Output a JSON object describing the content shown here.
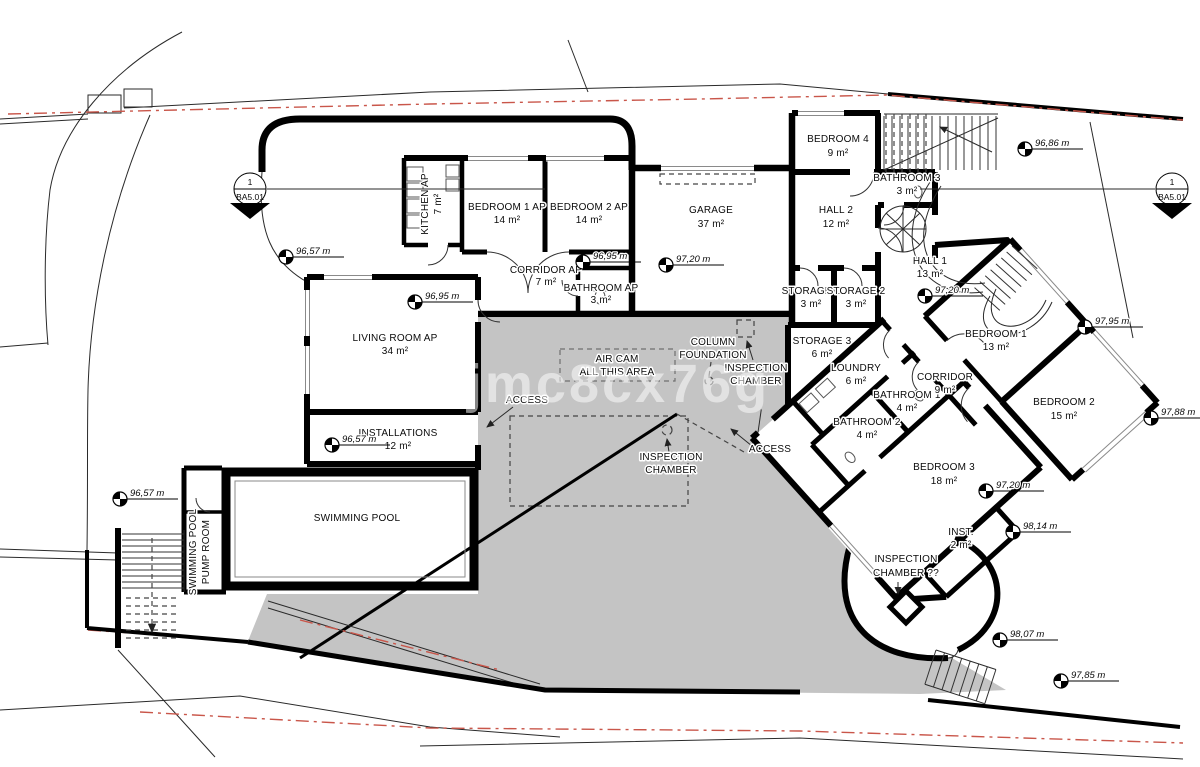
{
  "watermark": "kjmc8cx76g",
  "section_marker": {
    "number": "1",
    "sheet": "BA5.01"
  },
  "rooms": [
    {
      "name": "KITCHEN AP",
      "area": "7 m²"
    },
    {
      "name": "BEDROOM 1 AP",
      "area": "14 m²"
    },
    {
      "name": "BEDROOM 2 AP",
      "area": "14 m²"
    },
    {
      "name": "GARAGE",
      "area": "37 m²"
    },
    {
      "name": "BEDROOM 4",
      "area": "9 m²"
    },
    {
      "name": "BATHROOM 3",
      "area": "3 m²"
    },
    {
      "name": "HALL 2",
      "area": "12 m²"
    },
    {
      "name": "CORRIDOR AP",
      "area": "7 m²"
    },
    {
      "name": "BATHROOM AP",
      "area": "3 m²"
    },
    {
      "name": "HALL 1",
      "area": "13 m²"
    },
    {
      "name": "STORAGE 1",
      "area": "3 m²"
    },
    {
      "name": "STORAGE 2",
      "area": "3 m²"
    },
    {
      "name": "STORAGE 3",
      "area": "6 m²"
    },
    {
      "name": "LIVING ROOM AP",
      "area": "34 m²"
    },
    {
      "name": "LOUNDRY",
      "area": "6 m²"
    },
    {
      "name": "BATHROOM 1",
      "area": "4 m²"
    },
    {
      "name": "CORRIDOR",
      "area": "9 m²"
    },
    {
      "name": "BEDROOM 1",
      "area": "13 m²"
    },
    {
      "name": "BEDROOM 2",
      "area": "15 m²"
    },
    {
      "name": "BATHROOM 2",
      "area": "4 m²"
    },
    {
      "name": "BEDROOM 3",
      "area": "18 m²"
    },
    {
      "name": "INST.",
      "area": "2 m²"
    },
    {
      "name": "INSTALLATIONS",
      "area": "12 m²"
    },
    {
      "name": "SWIMMING POOL",
      "area": ""
    },
    {
      "name": "SWIMMING POOL",
      "area": "PUMP ROOM"
    }
  ],
  "labels": {
    "access": "ACCESS",
    "air_cam": [
      "AIR CAM",
      "ALL THIS AREA"
    ],
    "column_foundation": [
      "COLUMN",
      "FOUNDATION"
    ],
    "inspection_chamber": [
      "INSPECTION",
      "CHAMBER"
    ],
    "inspection_chamber_q": [
      "INSPECTION",
      "CHAMBER ??"
    ]
  },
  "elevations": [
    "96,57 m",
    "96,95 m",
    "96,95 m",
    "97,20 m",
    "96,86 m",
    "97,20 m",
    "97,95 m",
    "97,88 m",
    "97,20 m",
    "98,14 m",
    "98,07 m",
    "97,85 m",
    "96,57 m",
    "96,57 m"
  ]
}
